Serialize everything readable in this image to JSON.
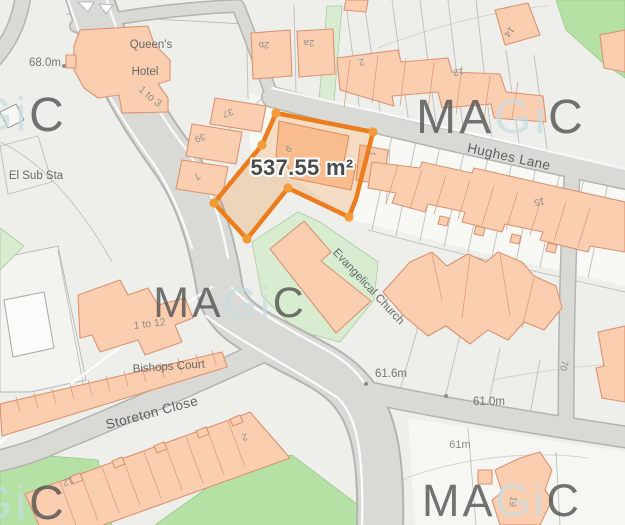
{
  "map": {
    "area_label": "537.55 m²",
    "streets": {
      "hughes_lane": "Hughes Lane",
      "storeton_close": "Storeton Close"
    },
    "places": {
      "queens_hotel_line1": "Queen's",
      "queens_hotel_line2": "Hotel",
      "queens_hotel_range": "1 to 3",
      "el_sub_sta": "El Sub Sta",
      "bishops_court": "Bishops Court",
      "bishops_court_range": "1 to 12",
      "evangelical_church": "Evangelical Church"
    },
    "elevations": {
      "e68": "68.0m",
      "e61_6": "61.6m",
      "e61_0": "61.0m",
      "e61": "61m"
    },
    "house_numbers": {
      "n37": "37",
      "n39": "39",
      "n7": "7",
      "n9": "9",
      "n2b": "2b",
      "n2a": "2a",
      "n2_top": "2",
      "n12_top": "12",
      "n14": "14",
      "n1": "1",
      "n15": "15",
      "n70": "70",
      "n2_bottom": "2",
      "n12_bottom": "12",
      "n19": "19"
    },
    "watermark": {
      "part1": "MA",
      "part2": "Gi",
      "part3": "C"
    },
    "colors": {
      "highlight_stroke": "#ec7c1c",
      "highlight_fill": "rgba(238,126,29,0.22)",
      "vertex_dot": "#f39b39",
      "building_fill": "#fbceb0",
      "building_stroke": "#dd9270",
      "road_fill": "#d9d9d6",
      "green_bright": "#b5e2a4",
      "green_pale": "#d8ecd0",
      "background": "#eeeeea",
      "label_gray": "#6d6d6d"
    }
  }
}
